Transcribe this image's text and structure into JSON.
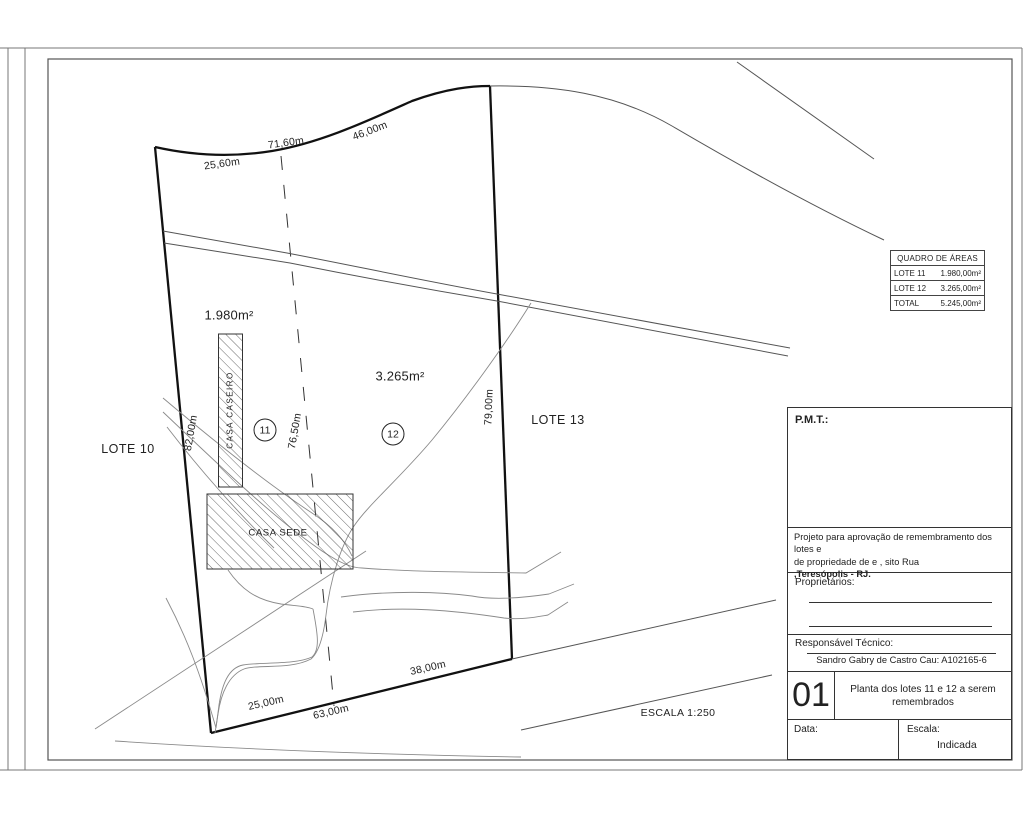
{
  "sheet": {
    "scale_note": "ESCALA 1:250"
  },
  "plan": {
    "lot11_area": "1.980m²",
    "lot12_area": "3.265m²",
    "lot11_number": "11",
    "lot12_number": "12",
    "lote10_label": "LOTE 10",
    "lote13_label": "LOTE 13",
    "casa_caseiro_label": "CASA CASEIRO",
    "casa_sede_label": "CASA SEDE",
    "dim_top_left": "25,60m",
    "dim_top_mid": "71,60m",
    "dim_top_right": "46,00m",
    "dim_left": "82,00m",
    "dim_divider": "76,50m",
    "dim_right": "79,00m",
    "dim_bottom_left": "25,00m",
    "dim_bottom_mid": "63,00m",
    "dim_bottom_right": "38,00m"
  },
  "areas_table": {
    "title": "QUADRO DE ÁREAS",
    "rows": [
      {
        "label": "LOTE 11",
        "value": "1.980,00m²"
      },
      {
        "label": "LOTE 12",
        "value": "3.265,00m²"
      },
      {
        "label": "TOTAL",
        "value": "5.245,00m²"
      }
    ]
  },
  "title_block": {
    "pmt_label": "P.M.T.:",
    "description_line1": "Projeto para aprovação de remembramento dos lotes  e",
    "description_line2": "de propriedade de e , sito Rua",
    "description_line3": ",Teresópolis - RJ.",
    "owners_label": "Proprietários:",
    "responsible_label": "Responsável Técnico:",
    "responsible_name": "Sandro Gabry de Castro Cau: A102165-6",
    "sheet_number": "01",
    "sheet_title_line1": "Planta dos lotes 11 e 12 a serem",
    "sheet_title_line2": "remembrados",
    "date_label": "Data:",
    "scale_label": "Escala:",
    "scale_value": "Indicada"
  }
}
